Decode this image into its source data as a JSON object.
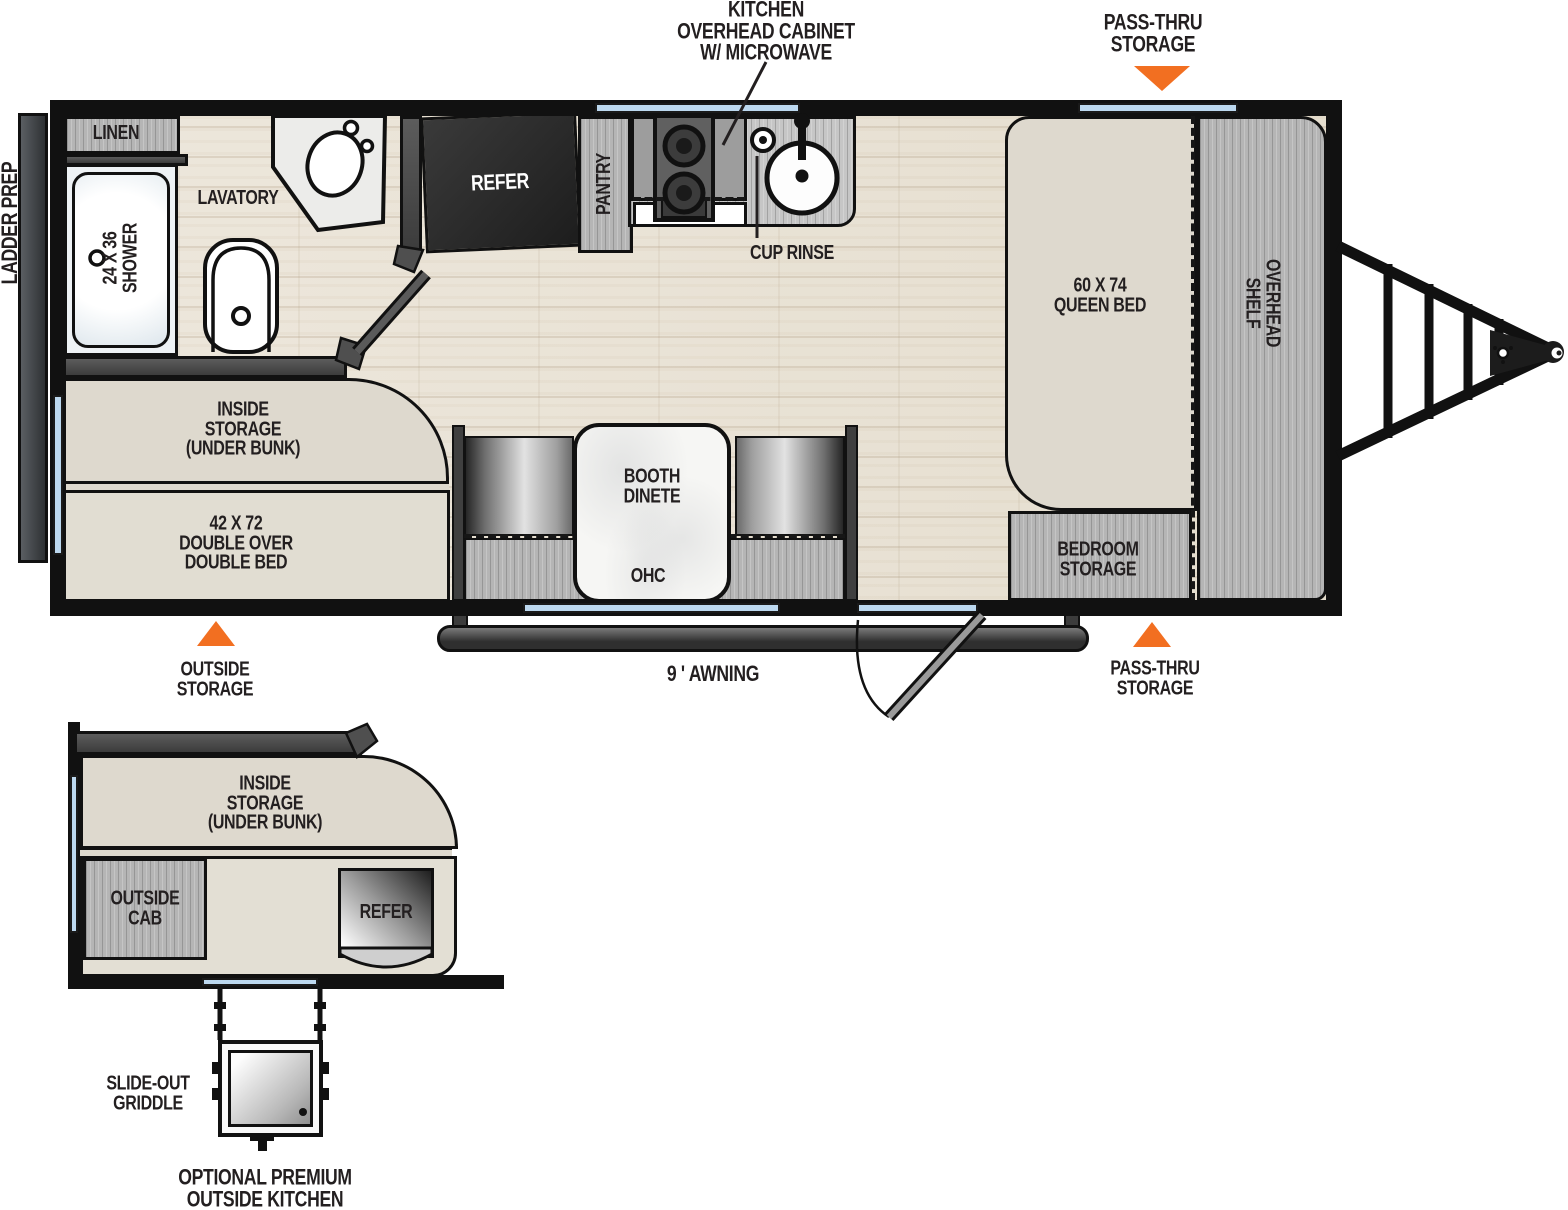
{
  "palette": {
    "wall": "#111111",
    "accent_orange": "#F26F21",
    "window_blue": "#BCD8EF",
    "label": "#231F20",
    "furniture_beige": "#DED9CE",
    "cabinet_gray": "#B5B5B5",
    "floor_wood": "#EAE3D7"
  },
  "callouts": {
    "kitchen_overhead": "KITCHEN\nOVERHEAD CABINET\nW/ MICROWAVE",
    "passthru_top": "PASS-THRU\nSTORAGE",
    "passthru_bottom": "PASS-THRU\nSTORAGE",
    "outside_storage": "OUTSIDE\nSTORAGE",
    "awning": "9 ' AWNING",
    "ladder_prep": "LADDER PREP"
  },
  "main": {
    "linen": "LINEN",
    "lavatory": "LAVATORY",
    "shower": "24 X 36\nSHOWER",
    "refer": "REFER",
    "pantry": "PANTRY",
    "cup_rinse": "CUP RINSE",
    "queen_bed": "60 X 74\nQUEEN BED",
    "overhead_shelf": "OVERHEAD\nSHELF",
    "inside_storage": "INSIDE\nSTORAGE\n(UNDER BUNK)",
    "double_bed": "42 X 72\nDOUBLE OVER\nDOUBLE BED",
    "booth_dinette": "BOOTH\nDINETE",
    "ohc": "OHC",
    "bedroom_storage": "BEDROOM\nSTORAGE"
  },
  "outside_kitchen": {
    "inside_storage": "INSIDE\nSTORAGE\n(UNDER BUNK)",
    "outside_cab": "OUTSIDE\nCAB",
    "refer": "REFER",
    "slide_out_griddle": "SLIDE-OUT\nGRIDDLE",
    "caption": "OPTIONAL PREMIUM\nOUTSIDE KITCHEN"
  }
}
